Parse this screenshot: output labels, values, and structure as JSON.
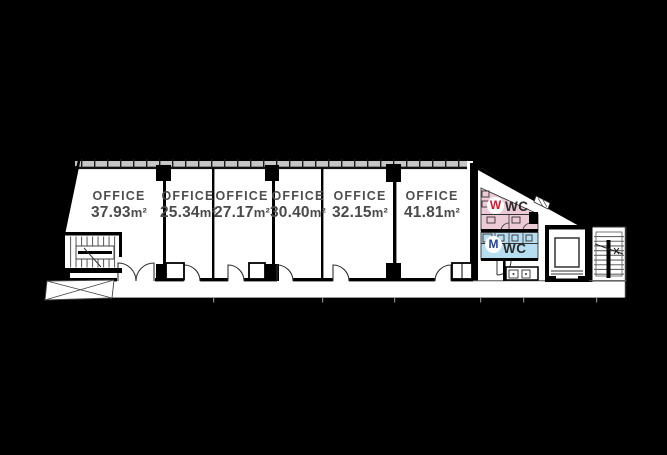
{
  "floorplan": {
    "offices": [
      {
        "label": "OFFICE",
        "area": "37.93",
        "unit": "m²"
      },
      {
        "label": "OFFICE",
        "area": "25.34",
        "unit": "m²"
      },
      {
        "label": "OFFICE",
        "area": "27.17",
        "unit": "m²"
      },
      {
        "label": "OFFICE",
        "area": "30.40",
        "unit": "m²"
      },
      {
        "label": "OFFICE",
        "area": "32.15",
        "unit": "m²"
      },
      {
        "label": "OFFICE",
        "area": "41.81",
        "unit": "m²"
      }
    ],
    "wc": {
      "womens": {
        "letter": "W",
        "label": "WC"
      },
      "mens": {
        "letter": "M",
        "label": "WC"
      }
    },
    "colors": {
      "background": "#000000",
      "floor": "#ffffff",
      "womens_wc_fill": "#eccbd6",
      "mens_wc_fill": "#b7ddf1",
      "womens_letter": "#d6152c",
      "mens_letter": "#20439c",
      "label_text": "#4b4b4b",
      "window_band": "#c6c6c6"
    }
  }
}
